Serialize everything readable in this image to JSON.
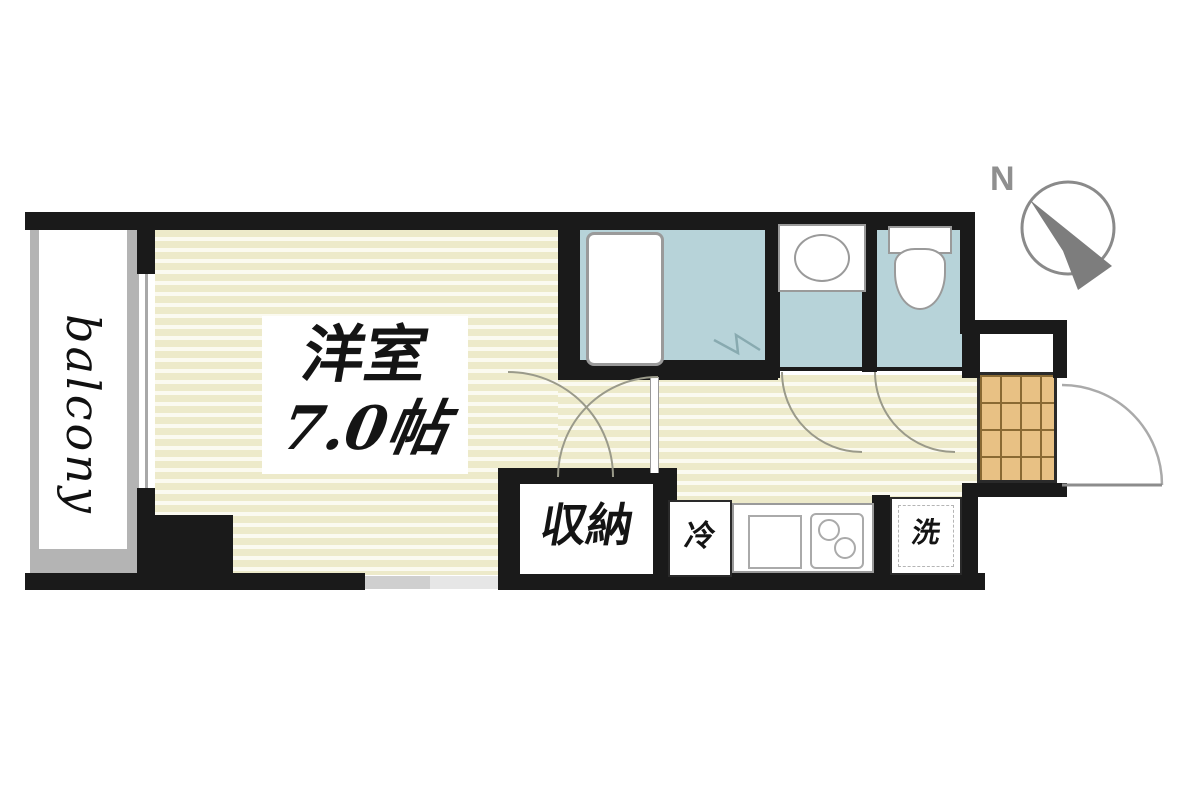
{
  "plan_type": "apartment-floor-plan",
  "labels": {
    "balcony": "balcony",
    "room_name": "洋室",
    "room_size": "7.0帖",
    "closet": "収納",
    "refrigerator": "冷",
    "washer": "洗",
    "compass_north": "N"
  },
  "rooms": [
    {
      "name": "balcony"
    },
    {
      "name": "洋室 7.0帖"
    },
    {
      "name": "収納"
    },
    {
      "name": "bathroom-with-tub"
    },
    {
      "name": "washbasin-room"
    },
    {
      "name": "toilet-room"
    },
    {
      "name": "kitchen-hallway"
    },
    {
      "name": "entrance-genkan"
    }
  ],
  "colors": {
    "wall": "#1a1a1a",
    "floor_stripe_base": "#edeaca",
    "floor_stripe_light": "#fbfaf0",
    "wet_area_blue": "#b7d3d9",
    "entrance_tile": "#e8c184",
    "tile_grid_line": "#8a6a33",
    "balcony_gray": "#b4b4b4",
    "compass_gray": "#8f8f8f",
    "door_arc": "#9a9a8a"
  }
}
